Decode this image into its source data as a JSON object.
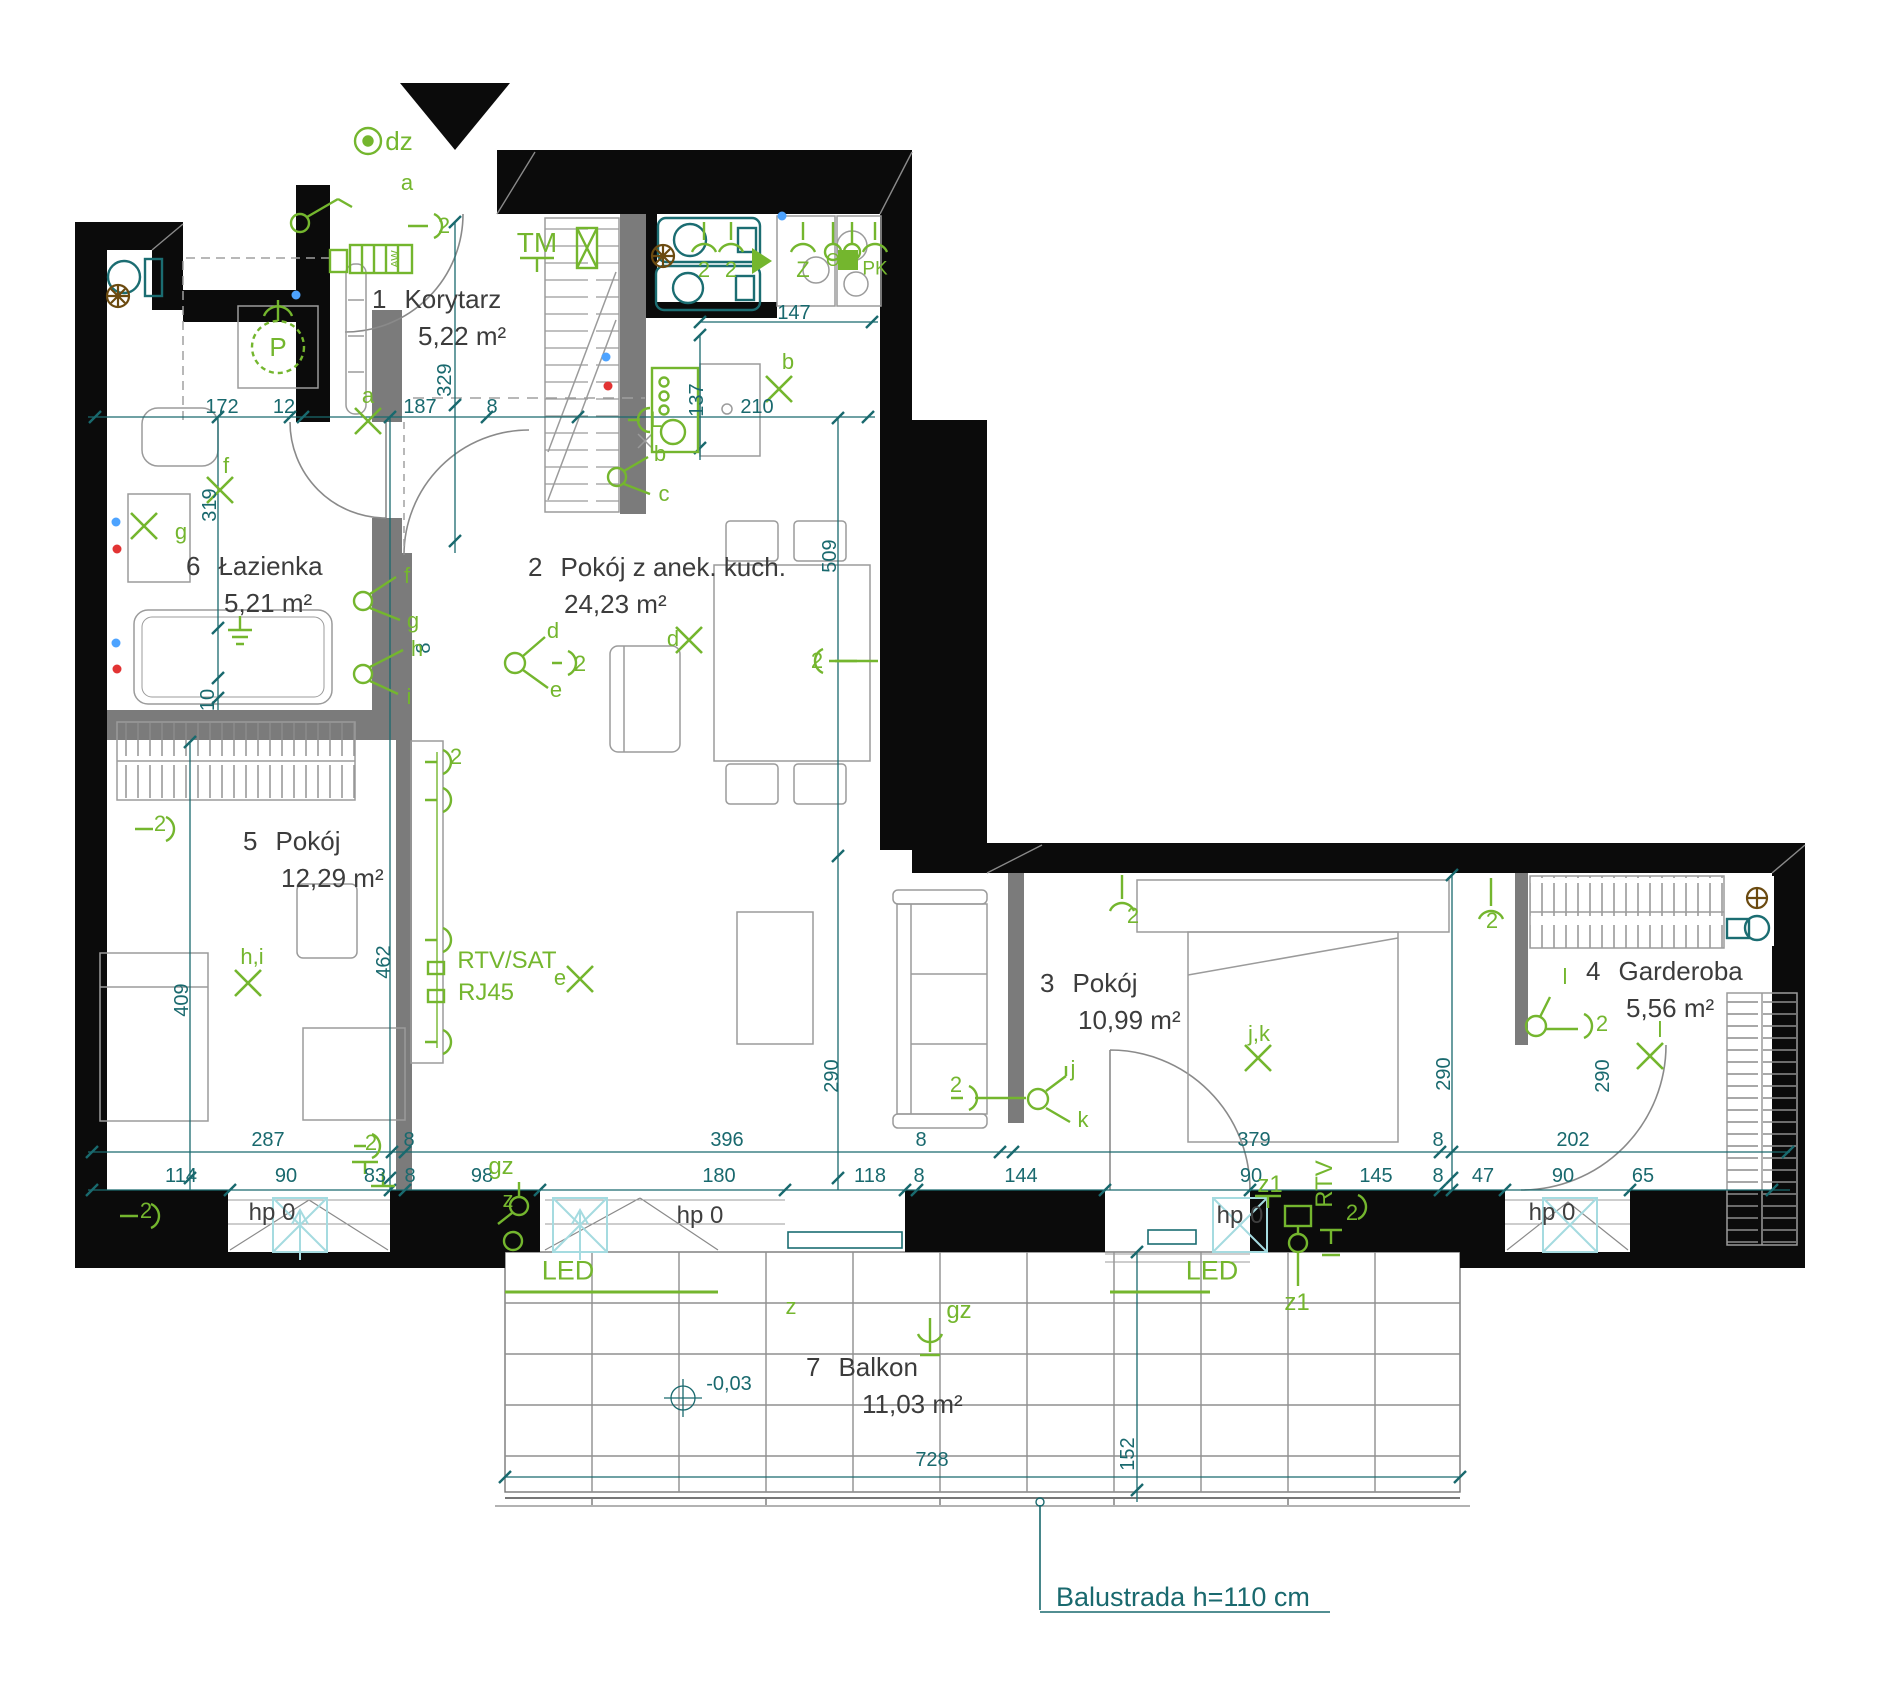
{
  "rooms": [
    {
      "num": "1",
      "name": "Korytarz",
      "area": "5,22 m²"
    },
    {
      "num": "2",
      "name": "Pokój z anek. kuch.",
      "area": "24,23 m²"
    },
    {
      "num": "3",
      "name": "Pokój",
      "area": "10,99 m²"
    },
    {
      "num": "4",
      "name": "Garderoba",
      "area": "5,56 m²"
    },
    {
      "num": "5",
      "name": "Pokój",
      "area": "12,29 m²"
    },
    {
      "num": "6",
      "name": "Łazienka",
      "area": "5,21 m²"
    },
    {
      "num": "7",
      "name": "Balkon",
      "area": "11,03 m²"
    }
  ],
  "annotations": {
    "balustrade": "Balustrada h=110 cm"
  },
  "colors": {
    "wall": "#0b0b0b",
    "partition": "#7b7b7b",
    "dimension": "#19696e",
    "electrical": "#74b62e",
    "window": "#a5dbe0",
    "furniture": "#9b9b9b",
    "valve": "#6b4a10",
    "point_blue": "#4da3ff",
    "point_red": "#e23333"
  },
  "dim_labels": [
    {
      "t": "172",
      "x": 222,
      "y": 407
    },
    {
      "t": "12",
      "x": 284,
      "y": 407
    },
    {
      "t": "187",
      "x": 420,
      "y": 407
    },
    {
      "t": "8",
      "x": 492,
      "y": 407
    },
    {
      "t": "210",
      "x": 757,
      "y": 407
    },
    {
      "t": "147",
      "x": 794,
      "y": 313
    },
    {
      "t": "137",
      "x": 697,
      "y": 400,
      "r": 1
    },
    {
      "t": "329",
      "x": 445,
      "y": 380,
      "r": 1
    },
    {
      "t": "319",
      "x": 210,
      "y": 505,
      "r": 1
    },
    {
      "t": "509",
      "x": 830,
      "y": 556,
      "r": 1
    },
    {
      "t": "8",
      "x": 424,
      "y": 648,
      "r": 1
    },
    {
      "t": "10",
      "x": 208,
      "y": 700,
      "r": 1
    },
    {
      "t": "462",
      "x": 384,
      "y": 962,
      "r": 1
    },
    {
      "t": "409",
      "x": 182,
      "y": 1000,
      "r": 1
    },
    {
      "t": "290",
      "x": 832,
      "y": 1076,
      "r": 1
    },
    {
      "t": "290",
      "x": 1444,
      "y": 1074,
      "r": 1
    },
    {
      "t": "290",
      "x": 1603,
      "y": 1076,
      "r": 1
    },
    {
      "t": "152",
      "x": 1128,
      "y": 1454,
      "r": 1
    },
    {
      "t": "287",
      "x": 268,
      "y": 1140
    },
    {
      "t": "8",
      "x": 409,
      "y": 1140
    },
    {
      "t": "396",
      "x": 727,
      "y": 1140
    },
    {
      "t": "8",
      "x": 921,
      "y": 1140
    },
    {
      "t": "379",
      "x": 1254,
      "y": 1140
    },
    {
      "t": "8",
      "x": 1438,
      "y": 1140
    },
    {
      "t": "202",
      "x": 1573,
      "y": 1140
    },
    {
      "t": "114",
      "x": 181,
      "y": 1176
    },
    {
      "t": "90",
      "x": 286,
      "y": 1176
    },
    {
      "t": "83",
      "x": 375,
      "y": 1176
    },
    {
      "t": "8",
      "x": 410,
      "y": 1176
    },
    {
      "t": "98",
      "x": 482,
      "y": 1176
    },
    {
      "t": "180",
      "x": 719,
      "y": 1176
    },
    {
      "t": "118",
      "x": 870,
      "y": 1176
    },
    {
      "t": "8",
      "x": 919,
      "y": 1176
    },
    {
      "t": "144",
      "x": 1021,
      "y": 1176
    },
    {
      "t": "90",
      "x": 1251,
      "y": 1176
    },
    {
      "t": "145",
      "x": 1376,
      "y": 1176
    },
    {
      "t": "8",
      "x": 1438,
      "y": 1176
    },
    {
      "t": "47",
      "x": 1483,
      "y": 1176
    },
    {
      "t": "90",
      "x": 1563,
      "y": 1176
    },
    {
      "t": "65",
      "x": 1643,
      "y": 1176
    },
    {
      "t": "728",
      "x": 932,
      "y": 1460
    },
    {
      "t": "-0,03",
      "x": 729,
      "y": 1384
    }
  ],
  "marker_labels": [
    {
      "t": "dz",
      "x": 399,
      "y": 141,
      "fs": 26
    },
    {
      "t": "a",
      "x": 407,
      "y": 183
    },
    {
      "t": "2",
      "x": 444,
      "y": 226
    },
    {
      "t": "a",
      "x": 368,
      "y": 396
    },
    {
      "t": "AW",
      "x": 396,
      "y": 259,
      "fs": 11,
      "r": 1
    },
    {
      "t": "TM",
      "x": 537,
      "y": 243,
      "fs": 28
    },
    {
      "t": "2",
      "x": 704,
      "y": 270
    },
    {
      "t": "2",
      "x": 731,
      "y": 270
    },
    {
      "t": "Z",
      "x": 803,
      "y": 270
    },
    {
      "t": "O",
      "x": 833,
      "y": 260,
      "fs": 18
    },
    {
      "t": "K",
      "x": 852,
      "y": 260,
      "fs": 18
    },
    {
      "t": "PK",
      "x": 875,
      "y": 269,
      "fs": 19
    },
    {
      "t": "b",
      "x": 788,
      "y": 362
    },
    {
      "t": "L",
      "x": 656,
      "y": 420
    },
    {
      "t": "b",
      "x": 660,
      "y": 454
    },
    {
      "t": "c",
      "x": 664,
      "y": 494
    },
    {
      "t": "d",
      "x": 553,
      "y": 631
    },
    {
      "t": "2",
      "x": 580,
      "y": 664
    },
    {
      "t": "e",
      "x": 556,
      "y": 690
    },
    {
      "t": "d",
      "x": 673,
      "y": 639
    },
    {
      "t": "2",
      "x": 817,
      "y": 661
    },
    {
      "t": "f",
      "x": 407,
      "y": 576
    },
    {
      "t": "g",
      "x": 413,
      "y": 621
    },
    {
      "t": "h",
      "x": 417,
      "y": 649
    },
    {
      "t": "i",
      "x": 409,
      "y": 697
    },
    {
      "t": "f",
      "x": 226,
      "y": 466
    },
    {
      "t": "g",
      "x": 181,
      "y": 532
    },
    {
      "t": "P",
      "x": 278,
      "y": 347,
      "fs": 26
    },
    {
      "t": "h,i",
      "x": 252,
      "y": 957
    },
    {
      "t": "2",
      "x": 160,
      "y": 824
    },
    {
      "t": "2",
      "x": 146,
      "y": 1211
    },
    {
      "t": "RTV/SAT",
      "x": 507,
      "y": 961,
      "fs": 24
    },
    {
      "t": "RJ45",
      "x": 486,
      "y": 993,
      "fs": 24
    },
    {
      "t": "e",
      "x": 560,
      "y": 978
    },
    {
      "t": "2",
      "x": 456,
      "y": 757
    },
    {
      "t": "2",
      "x": 371,
      "y": 1143
    },
    {
      "t": "gz",
      "x": 501,
      "y": 1167,
      "fs": 24
    },
    {
      "t": "z",
      "x": 508,
      "y": 1200
    },
    {
      "t": "LED",
      "x": 568,
      "y": 1271,
      "fs": 27
    },
    {
      "t": "z",
      "x": 791,
      "y": 1307
    },
    {
      "t": "gz",
      "x": 959,
      "y": 1311,
      "fs": 24
    },
    {
      "t": "2",
      "x": 1133,
      "y": 916
    },
    {
      "t": "j",
      "x": 1073,
      "y": 1069
    },
    {
      "t": "k",
      "x": 1083,
      "y": 1120
    },
    {
      "t": "2",
      "x": 956,
      "y": 1085
    },
    {
      "t": "j,k",
      "x": 1259,
      "y": 1034
    },
    {
      "t": "2",
      "x": 1492,
      "y": 921
    },
    {
      "t": "z1",
      "x": 1270,
      "y": 1185,
      "fs": 24
    },
    {
      "t": "RTV",
      "x": 1325,
      "y": 1184,
      "fs": 24,
      "r": 1
    },
    {
      "t": "2",
      "x": 1352,
      "y": 1213
    },
    {
      "t": "z1",
      "x": 1297,
      "y": 1303,
      "fs": 24
    },
    {
      "t": "LED",
      "x": 1212,
      "y": 1271,
      "fs": 27
    },
    {
      "t": "l",
      "x": 1565,
      "y": 977
    },
    {
      "t": "2",
      "x": 1602,
      "y": 1024
    },
    {
      "t": "l",
      "x": 1660,
      "y": 1030
    }
  ],
  "hp_labels": [
    {
      "t": "hp 0",
      "x": 272,
      "y": 1213
    },
    {
      "t": "hp 0",
      "x": 700,
      "y": 1216
    },
    {
      "t": "hp 0",
      "x": 1240,
      "y": 1216
    },
    {
      "t": "hp 0",
      "x": 1552,
      "y": 1213
    }
  ]
}
